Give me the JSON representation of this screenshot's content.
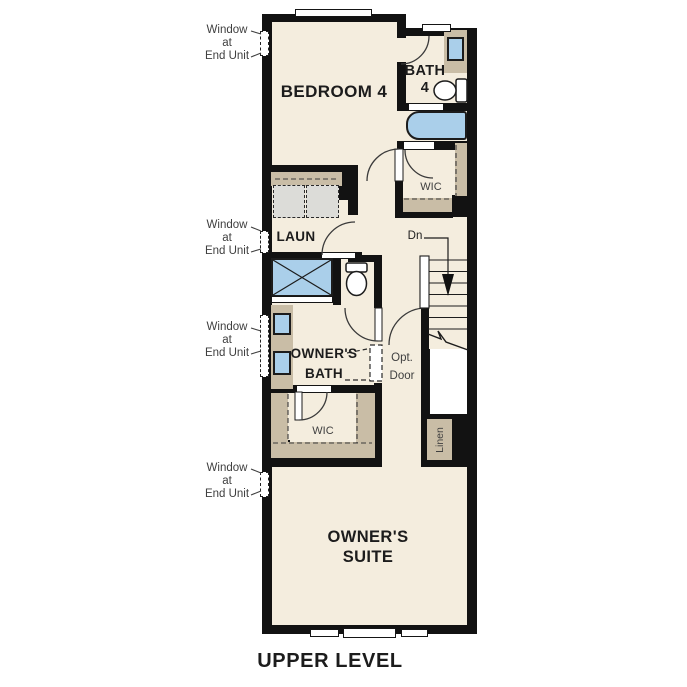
{
  "plan": {
    "caption": "UPPER LEVEL",
    "rooms": {
      "bedroom4": {
        "label": "BEDROOM 4"
      },
      "bath4": {
        "label_line1": "BATH",
        "label_line2": "4"
      },
      "laundry": {
        "label": "LAUN"
      },
      "wic_bath4": {
        "label": "WIC"
      },
      "owners_bath": {
        "label_line1": "OWNER'S",
        "label_line2": "BATH"
      },
      "wic_owners": {
        "label": "WIC"
      },
      "owners_suite": {
        "label_line1": "OWNER'S",
        "label_line2": "SUITE"
      },
      "linen": {
        "label": "Linen"
      }
    },
    "stairs": {
      "down_label": "Dn"
    },
    "opt_door": {
      "label_line1": "Opt.",
      "label_line2": "Door"
    },
    "window_note": {
      "line1": "Window",
      "line2": "at",
      "line3": "End Unit"
    },
    "colors": {
      "wall": "#121212",
      "floor": "#f4edde",
      "fixture_tan": "#c9bda6",
      "fixture_blue": "#aacfea",
      "appliance_gray": "#dcdcd8",
      "text_primary": "#1c1c1c",
      "text_secondary": "#3f3f3f"
    }
  }
}
